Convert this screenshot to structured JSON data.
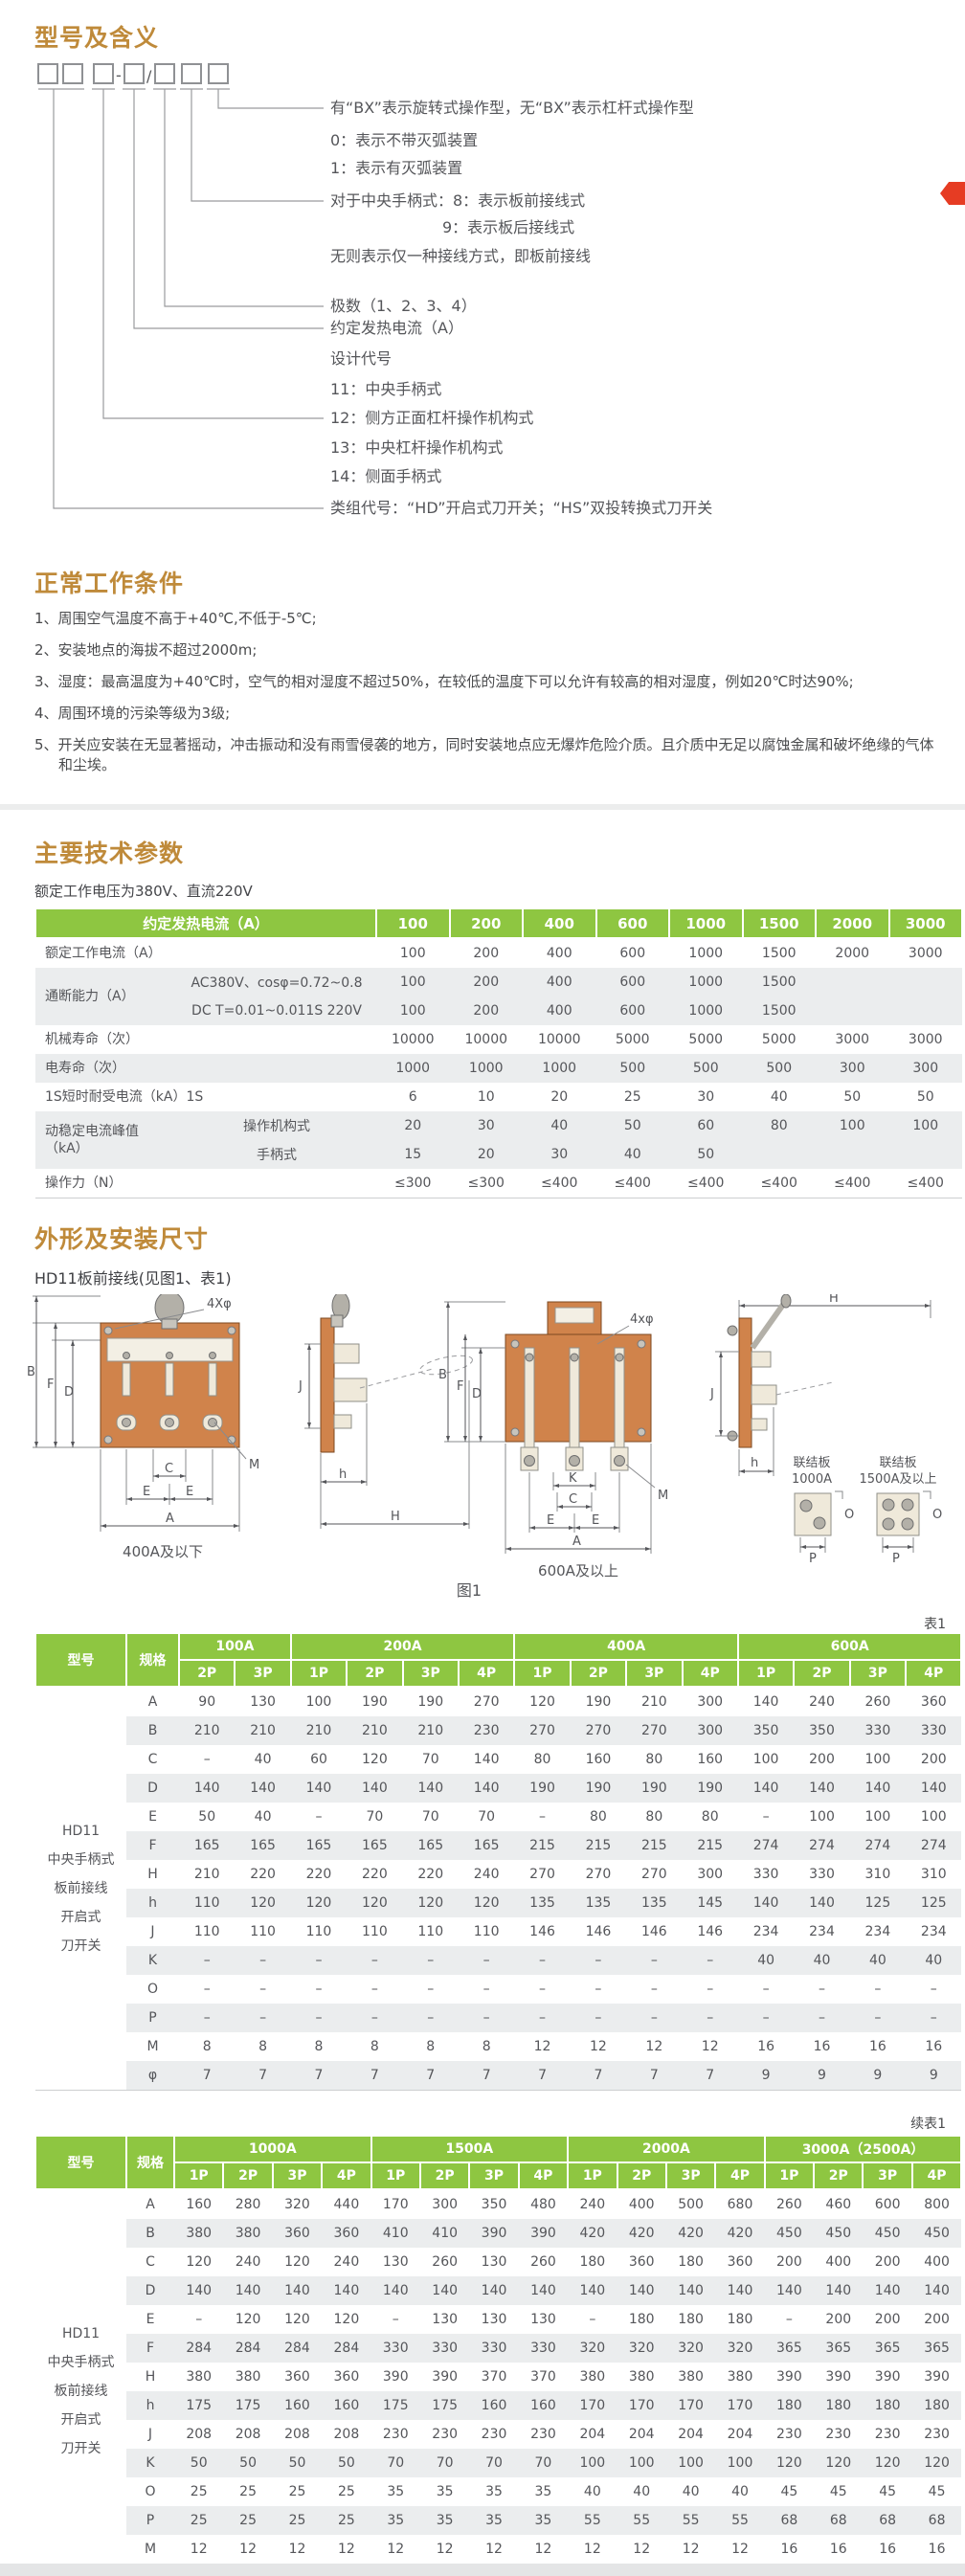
{
  "page": {
    "accent_color": "#bf8a3a",
    "header_green": "#8ec641",
    "shade_gray": "#ebedee",
    "red_tab_color": "#e63c23"
  },
  "model_section": {
    "title": "型号及含义",
    "code_boxes": [
      "□",
      "□",
      "□",
      "-",
      "□",
      "/",
      "□",
      "□",
      "□"
    ],
    "separators": {
      "hyphen": "-",
      "slash": "/"
    },
    "labels": [
      "有“BX”表示旋转式操作型，无“BX”表示杠杆式操作型",
      "0：表示不带灭弧装置",
      "1：表示有灭弧装置",
      "对于中央手柄式：8：表示板前接线式",
      "9：表示板后接线式",
      "无则表示仅一种接线方式，即板前接线",
      "极数（1、2、3、4）",
      "约定发热电流（A）",
      "设计代号",
      "11：中央手柄式",
      "12：侧方正面杠杆操作机构式",
      "13：中央杠杆操作机构式",
      "14：侧面手柄式",
      "类组代号：“HD”开启式刀开关；“HS”双投转换式刀开关"
    ]
  },
  "conditions_section": {
    "title": "正常工作条件",
    "items": [
      "1、周围空气温度不高于+40℃,不低于-5℃;",
      "2、安装地点的海拔不超过2000m;",
      "3、湿度：最高温度为+40℃时，空气的相对湿度不超过50%，在较低的温度下可以允许有较高的相对湿度，例如20℃时达90%;",
      "4、周围环境的污染等级为3级;",
      "5、开关应安装在无显著摇动，冲击振动和没有雨雪侵袭的地方，同时安装地点应无爆炸危险介质。且介质中无足以腐蚀金属和破坏绝缘的气体和尘埃。"
    ]
  },
  "tech_section": {
    "title": "主要技术参数",
    "subtitle": "额定工作电压为380V、直流220V",
    "table": {
      "header": [
        "约定发热电流（A）",
        "100",
        "200",
        "400",
        "600",
        "1000",
        "1500",
        "2000",
        "3000"
      ],
      "rows": [
        {
          "label": "额定工作电流（A）",
          "labelcolspan": 2,
          "shade": false,
          "values": [
            "100",
            "200",
            "400",
            "600",
            "1000",
            "1500",
            "2000",
            "3000"
          ]
        },
        {
          "label": "通断能力（A）",
          "labelspan": 2,
          "sub": "AC380V、cosφ=0.72~0.8",
          "shade": true,
          "values": [
            "100",
            "200",
            "400",
            "600",
            "1000",
            "1500",
            "",
            ""
          ]
        },
        {
          "sub": "DC T=0.01~0.011S 220V",
          "shade": true,
          "values": [
            "100",
            "200",
            "400",
            "600",
            "1000",
            "1500",
            "",
            ""
          ]
        },
        {
          "label": "机械寿命（次）",
          "labelcolspan": 2,
          "shade": false,
          "values": [
            "10000",
            "10000",
            "10000",
            "5000",
            "5000",
            "5000",
            "3000",
            "3000"
          ]
        },
        {
          "label": "电寿命（次）",
          "labelcolspan": 2,
          "shade": true,
          "values": [
            "1000",
            "1000",
            "1000",
            "500",
            "500",
            "500",
            "300",
            "300"
          ]
        },
        {
          "label": "1S短时耐受电流（kA）1S",
          "labelcolspan": 2,
          "shade": false,
          "values": [
            "6",
            "10",
            "20",
            "25",
            "30",
            "40",
            "50",
            "50"
          ]
        },
        {
          "label": "动稳定电流峰值\n（kA）",
          "labelspan": 2,
          "sub": "操作机构式",
          "shade": true,
          "values": [
            "20",
            "30",
            "40",
            "50",
            "60",
            "80",
            "100",
            "100"
          ]
        },
        {
          "sub": "手柄式",
          "shade": true,
          "values": [
            "15",
            "20",
            "30",
            "40",
            "50",
            "",
            "",
            ""
          ]
        },
        {
          "label": "操作力（N）",
          "labelcolspan": 2,
          "shade": false,
          "values": [
            "≤300",
            "≤300",
            "≤400",
            "≤400",
            "≤400",
            "≤400",
            "≤400",
            "≤400"
          ]
        }
      ]
    }
  },
  "dims_section": {
    "title": "外形及安装尺寸",
    "subtitle": "HD11板前接线(见图1、表1)",
    "figure": {
      "caption": "图1",
      "front_small_caption": "400A及以下",
      "front_large_caption": "600A及以上",
      "callout_holes_small": "4Xφ",
      "callout_holes_large": "4xφ",
      "connector_small": [
        "联结板",
        "1000A"
      ],
      "connector_large": [
        "联结板",
        "1500A及以上"
      ],
      "dims": {
        "A": "A",
        "B": "B",
        "C": "C",
        "D": "D",
        "E": "E",
        "F": "F",
        "H": "H",
        "J": "J",
        "K": "K",
        "M": "M",
        "O": "O",
        "P": "P",
        "h": "h"
      }
    },
    "table1": {
      "tag": "表1",
      "head": {
        "model": "型号",
        "spec": "规格",
        "groups": [
          {
            "label": "100A",
            "cols": [
              "2P",
              "3P"
            ]
          },
          {
            "label": "200A",
            "cols": [
              "1P",
              "2P",
              "3P",
              "4P"
            ]
          },
          {
            "label": "400A",
            "cols": [
              "1P",
              "2P",
              "3P",
              "4P"
            ]
          },
          {
            "label": "600A",
            "cols": [
              "1P",
              "2P",
              "3P",
              "4P"
            ]
          }
        ]
      },
      "model_lines": [
        "HD11",
        "中央手柄式",
        "板前接线",
        "开启式",
        "刀开关"
      ],
      "rows": [
        {
          "spec": "A",
          "values": [
            "90",
            "130",
            "100",
            "190",
            "190",
            "270",
            "120",
            "190",
            "210",
            "300",
            "140",
            "240",
            "260",
            "360"
          ]
        },
        {
          "spec": "B",
          "values": [
            "210",
            "210",
            "210",
            "210",
            "210",
            "230",
            "270",
            "270",
            "270",
            "300",
            "350",
            "350",
            "330",
            "330"
          ]
        },
        {
          "spec": "C",
          "values": [
            "–",
            "40",
            "60",
            "120",
            "70",
            "140",
            "80",
            "160",
            "80",
            "160",
            "100",
            "200",
            "100",
            "200"
          ]
        },
        {
          "spec": "D",
          "values": [
            "140",
            "140",
            "140",
            "140",
            "140",
            "140",
            "190",
            "190",
            "190",
            "190",
            "140",
            "140",
            "140",
            "140"
          ]
        },
        {
          "spec": "E",
          "values": [
            "50",
            "40",
            "–",
            "70",
            "70",
            "70",
            "–",
            "80",
            "80",
            "80",
            "–",
            "100",
            "100",
            "100"
          ]
        },
        {
          "spec": "F",
          "values": [
            "165",
            "165",
            "165",
            "165",
            "165",
            "165",
            "215",
            "215",
            "215",
            "215",
            "274",
            "274",
            "274",
            "274"
          ]
        },
        {
          "spec": "H",
          "values": [
            "210",
            "220",
            "220",
            "220",
            "220",
            "240",
            "270",
            "270",
            "270",
            "300",
            "330",
            "330",
            "310",
            "310"
          ]
        },
        {
          "spec": "h",
          "values": [
            "110",
            "120",
            "120",
            "120",
            "120",
            "120",
            "135",
            "135",
            "135",
            "145",
            "140",
            "140",
            "125",
            "125"
          ]
        },
        {
          "spec": "J",
          "values": [
            "110",
            "110",
            "110",
            "110",
            "110",
            "110",
            "146",
            "146",
            "146",
            "146",
            "234",
            "234",
            "234",
            "234"
          ]
        },
        {
          "spec": "K",
          "values": [
            "–",
            "–",
            "–",
            "–",
            "–",
            "–",
            "–",
            "–",
            "–",
            "–",
            "40",
            "40",
            "40",
            "40"
          ]
        },
        {
          "spec": "O",
          "values": [
            "–",
            "–",
            "–",
            "–",
            "–",
            "–",
            "–",
            "–",
            "–",
            "–",
            "–",
            "–",
            "–",
            "–"
          ]
        },
        {
          "spec": "P",
          "values": [
            "–",
            "–",
            "–",
            "–",
            "–",
            "–",
            "–",
            "–",
            "–",
            "–",
            "–",
            "–",
            "–",
            "–"
          ]
        },
        {
          "spec": "M",
          "values": [
            "8",
            "8",
            "8",
            "8",
            "8",
            "8",
            "12",
            "12",
            "12",
            "12",
            "16",
            "16",
            "16",
            "16"
          ]
        },
        {
          "spec": "φ",
          "values": [
            "7",
            "7",
            "7",
            "7",
            "7",
            "7",
            "7",
            "7",
            "7",
            "7",
            "9",
            "9",
            "9",
            "9"
          ]
        }
      ]
    },
    "table2": {
      "tag": "续表1",
      "head": {
        "model": "型号",
        "spec": "规格",
        "groups": [
          {
            "label": "1000A",
            "cols": [
              "1P",
              "2P",
              "3P",
              "4P"
            ]
          },
          {
            "label": "1500A",
            "cols": [
              "1P",
              "2P",
              "3P",
              "4P"
            ]
          },
          {
            "label": "2000A",
            "cols": [
              "1P",
              "2P",
              "3P",
              "4P"
            ]
          },
          {
            "label": "3000A（2500A）",
            "cols": [
              "1P",
              "2P",
              "3P",
              "4P"
            ]
          }
        ]
      },
      "model_lines": [
        "HD11",
        "中央手柄式",
        "板前接线",
        "开启式",
        "刀开关"
      ],
      "rows": [
        {
          "spec": "A",
          "values": [
            "160",
            "280",
            "320",
            "440",
            "170",
            "300",
            "350",
            "480",
            "240",
            "400",
            "500",
            "680",
            "260",
            "460",
            "600",
            "800"
          ]
        },
        {
          "spec": "B",
          "values": [
            "380",
            "380",
            "360",
            "360",
            "410",
            "410",
            "390",
            "390",
            "420",
            "420",
            "420",
            "420",
            "450",
            "450",
            "450",
            "450"
          ]
        },
        {
          "spec": "C",
          "values": [
            "120",
            "240",
            "120",
            "240",
            "130",
            "260",
            "130",
            "260",
            "180",
            "360",
            "180",
            "360",
            "200",
            "400",
            "200",
            "400"
          ]
        },
        {
          "spec": "D",
          "values": [
            "140",
            "140",
            "140",
            "140",
            "140",
            "140",
            "140",
            "140",
            "140",
            "140",
            "140",
            "140",
            "140",
            "140",
            "140",
            "140"
          ]
        },
        {
          "spec": "E",
          "values": [
            "–",
            "120",
            "120",
            "120",
            "–",
            "130",
            "130",
            "130",
            "–",
            "180",
            "180",
            "180",
            "–",
            "200",
            "200",
            "200"
          ]
        },
        {
          "spec": "F",
          "values": [
            "284",
            "284",
            "284",
            "284",
            "330",
            "330",
            "330",
            "330",
            "320",
            "320",
            "320",
            "320",
            "365",
            "365",
            "365",
            "365"
          ]
        },
        {
          "spec": "H",
          "values": [
            "380",
            "380",
            "360",
            "360",
            "390",
            "390",
            "370",
            "370",
            "380",
            "380",
            "380",
            "380",
            "390",
            "390",
            "390",
            "390"
          ]
        },
        {
          "spec": "h",
          "values": [
            "175",
            "175",
            "160",
            "160",
            "175",
            "175",
            "160",
            "160",
            "170",
            "170",
            "170",
            "170",
            "180",
            "180",
            "180",
            "180"
          ]
        },
        {
          "spec": "J",
          "values": [
            "208",
            "208",
            "208",
            "208",
            "230",
            "230",
            "230",
            "230",
            "204",
            "204",
            "204",
            "204",
            "230",
            "230",
            "230",
            "230"
          ]
        },
        {
          "spec": "K",
          "values": [
            "50",
            "50",
            "50",
            "50",
            "70",
            "70",
            "70",
            "70",
            "100",
            "100",
            "100",
            "100",
            "120",
            "120",
            "120",
            "120"
          ]
        },
        {
          "spec": "O",
          "values": [
            "25",
            "25",
            "25",
            "25",
            "35",
            "35",
            "35",
            "35",
            "40",
            "40",
            "40",
            "40",
            "45",
            "45",
            "45",
            "45"
          ]
        },
        {
          "spec": "P",
          "values": [
            "25",
            "25",
            "25",
            "25",
            "35",
            "35",
            "35",
            "35",
            "55",
            "55",
            "55",
            "55",
            "68",
            "68",
            "68",
            "68"
          ]
        },
        {
          "spec": "M",
          "values": [
            "12",
            "12",
            "12",
            "12",
            "12",
            "12",
            "12",
            "12",
            "12",
            "12",
            "12",
            "12",
            "16",
            "16",
            "16",
            "16"
          ]
        },
        {
          "spec": "φ",
          "values": [
            "9",
            "9",
            "9",
            "9",
            "9",
            "9",
            "9",
            "9",
            "9",
            "9",
            "9",
            "9",
            "11",
            "11",
            "11",
            "11"
          ]
        }
      ]
    }
  }
}
